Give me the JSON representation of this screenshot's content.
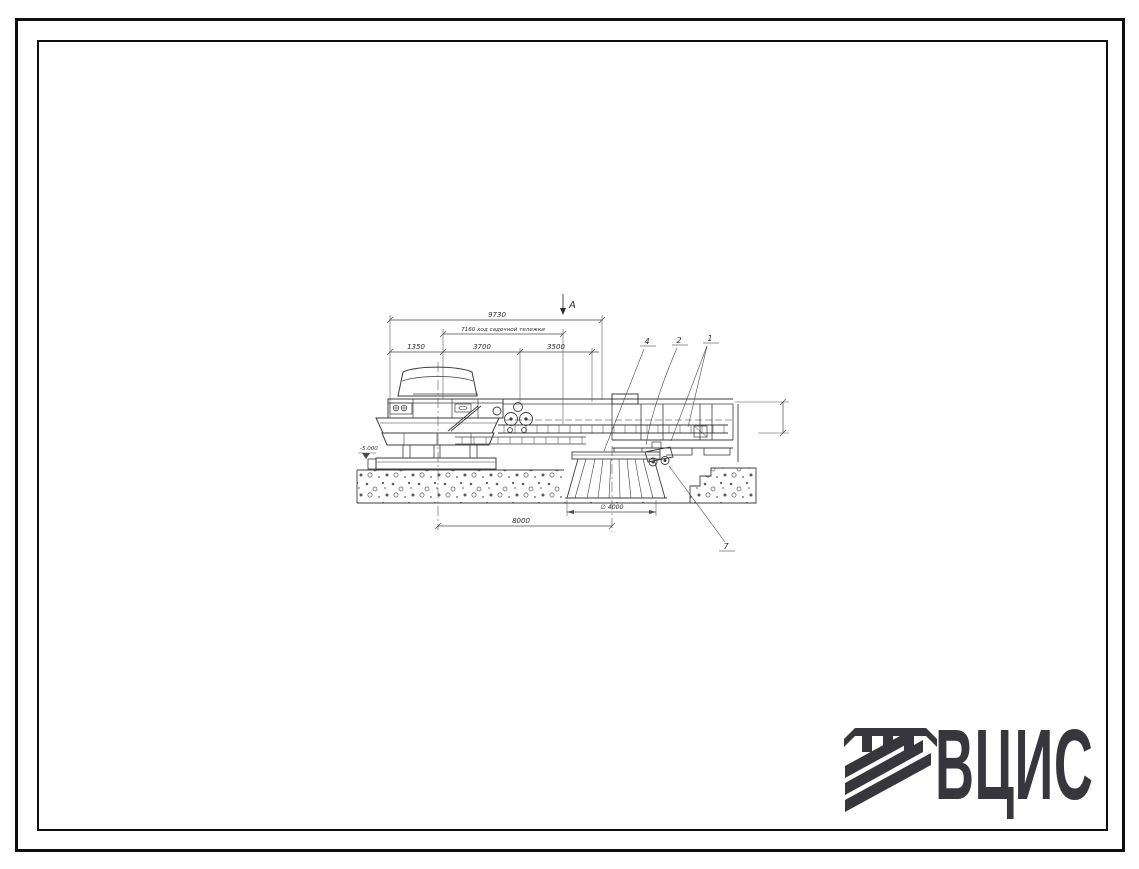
{
  "page": {
    "frame_color": "#0e0e0e",
    "background": "#ffffff"
  },
  "drawing": {
    "line_color": "#3c3c3c",
    "section_label": "А",
    "dim_overall": "9730",
    "dim_travel": "7160 ход садочной тележки",
    "dim_seg1": "1350",
    "dim_seg2": "3700",
    "dim_seg3": "3500",
    "dim_diameter": "∅ 4000",
    "dim_span": "8000",
    "elevation_mark": "-5.000",
    "callouts": [
      "4",
      "2",
      "1",
      "7"
    ]
  },
  "logo": {
    "text": "ВЦИС",
    "color": "#36363c"
  }
}
